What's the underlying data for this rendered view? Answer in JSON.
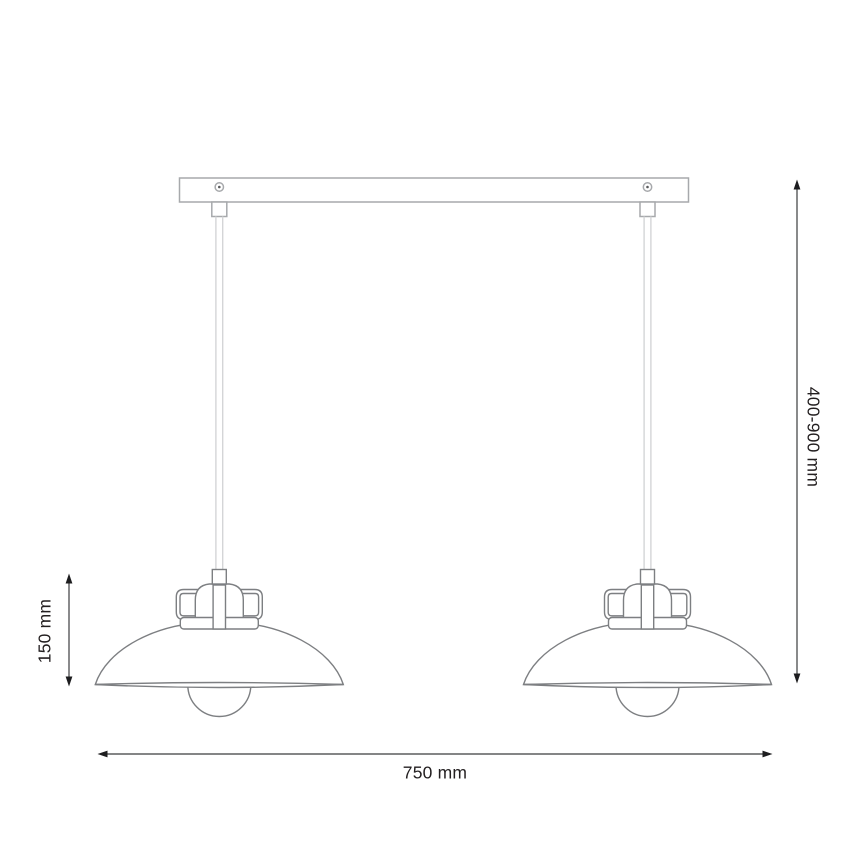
{
  "figure": {
    "subject": "Double pendant ceiling lamp — dimensional line drawing",
    "lamp_count": 2
  },
  "dimensions": {
    "suspension_height": "400-900 mm",
    "shade_height": "150 mm",
    "overall_width": "750 mm"
  },
  "colors": {
    "background": "#ffffff",
    "fixture_line": "#7d7f82",
    "mount_line": "#a7a9ac",
    "cable_line": "#d4d5d7",
    "dimension_line": "#3b3c3e",
    "dimension_text": "#231f20"
  }
}
